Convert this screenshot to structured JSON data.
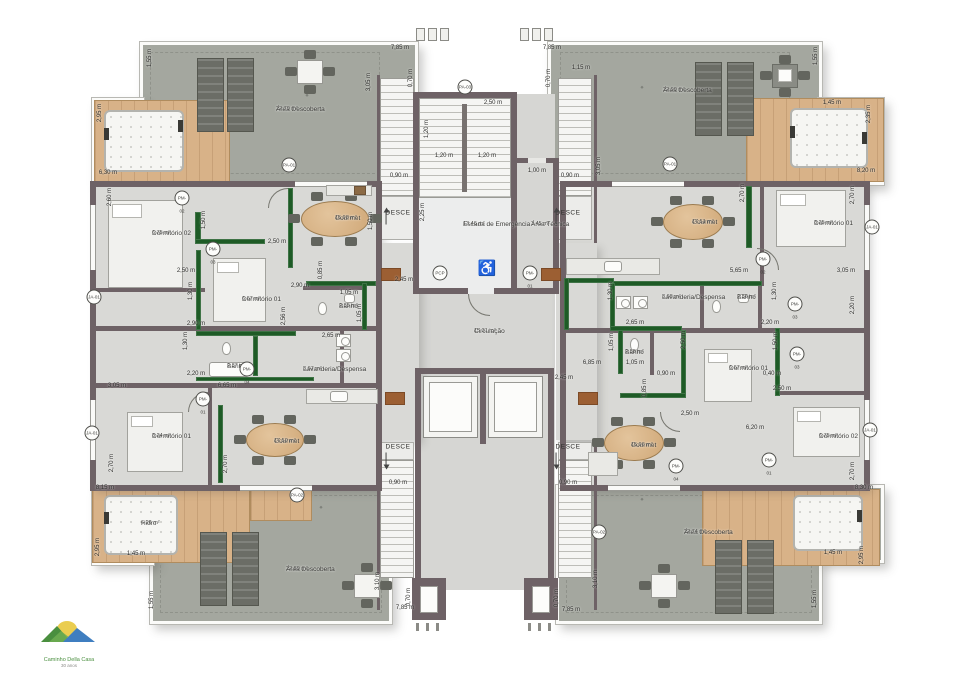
{
  "labels": {
    "desce": "DESCE"
  },
  "logo": {
    "line1": "Caminho Della Casa",
    "line2": "30 anos"
  },
  "colors": {
    "wall": "#6e6266",
    "green_wall": "#1e5b26",
    "terrace": "#a4a79f",
    "deck": "#d8b288",
    "interior": "#d9d9d6"
  },
  "rooms": [
    {
      "name": "Área Descoberta",
      "area": "22,70 m²",
      "x": 276,
      "y": 106
    },
    {
      "name": "Área Descoberta",
      "area": "22,90 m²",
      "x": 663,
      "y": 87
    },
    {
      "name": "Área Descoberta",
      "area": "22,89 m²",
      "x": 286,
      "y": 566
    },
    {
      "name": "Área Descoberta",
      "area": "22,74 m²",
      "x": 684,
      "y": 529
    },
    {
      "name": "Dormitório 02",
      "area": "6,75 m²",
      "x": 152,
      "y": 230
    },
    {
      "name": "Dormitório 01",
      "area": "6,67 m²",
      "x": 242,
      "y": 296
    },
    {
      "name": "Gourmet",
      "area": "15,98 m²",
      "x": 335,
      "y": 215
    },
    {
      "name": "Banho",
      "area": "2,85 m²",
      "x": 339,
      "y": 303
    },
    {
      "name": "Banho",
      "area": "2,87 m²",
      "x": 227,
      "y": 363
    },
    {
      "name": "Lavanderia/Despensa",
      "area": "3,67 m²",
      "x": 303,
      "y": 366
    },
    {
      "name": "Gourmet",
      "area": "17,51 m²",
      "x": 692,
      "y": 219
    },
    {
      "name": "Dormitório 01",
      "area": "8,25 m²",
      "x": 814,
      "y": 220
    },
    {
      "name": "Lavanderia/Despensa",
      "area": "3,68 m²",
      "x": 662,
      "y": 294
    },
    {
      "name": "Banho",
      "area": "2,86 m²",
      "x": 737,
      "y": 294
    },
    {
      "name": "Banho",
      "area": "2,88 m²",
      "x": 625,
      "y": 349
    },
    {
      "name": "Dormitório 01",
      "area": "6,67 m²",
      "x": 729,
      "y": 365
    },
    {
      "name": "Gourmet",
      "area": "15,96 m²",
      "x": 631,
      "y": 442
    },
    {
      "name": "Dormitório 02",
      "area": "6,75 m²",
      "x": 819,
      "y": 433
    },
    {
      "name": "Dormitório 01",
      "area": "8,24 m²",
      "x": 152,
      "y": 433
    },
    {
      "name": "Gourmet",
      "area": "17,50 m²",
      "x": 274,
      "y": 438
    },
    {
      "name": "Hidro",
      "area": "6,26 m²",
      "x": 141,
      "y": 520
    },
    {
      "name": "Escada de Emergência",
      "area": "13,46 m²",
      "x": 463,
      "y": 221
    },
    {
      "name": "Área Técnica",
      "area": "3,45 m²",
      "x": 531,
      "y": 221
    },
    {
      "name": "Circulação",
      "area": "15,31 m²",
      "x": 474,
      "y": 328
    }
  ],
  "dims": [
    {
      "t": "7,85 m",
      "x": 400,
      "y": 48
    },
    {
      "t": "0,70 m",
      "x": 411,
      "y": 78,
      "v": 1
    },
    {
      "t": "7,85 m",
      "x": 552,
      "y": 48
    },
    {
      "t": "0,70 m",
      "x": 549,
      "y": 78,
      "v": 1
    },
    {
      "t": "1,15 m",
      "x": 581,
      "y": 68
    },
    {
      "t": "2,50 m",
      "x": 493,
      "y": 103
    },
    {
      "t": "1,20 m",
      "x": 427,
      "y": 129,
      "v": 1
    },
    {
      "t": "1,20 m",
      "x": 444,
      "y": 156
    },
    {
      "t": "1,20 m",
      "x": 487,
      "y": 156
    },
    {
      "t": "1,00 m",
      "x": 537,
      "y": 171
    },
    {
      "t": "0,90 m",
      "x": 399,
      "y": 176
    },
    {
      "t": "0,90 m",
      "x": 570,
      "y": 176
    },
    {
      "t": "2,25 m",
      "x": 423,
      "y": 212,
      "v": 1
    },
    {
      "t": "3,05 m",
      "x": 369,
      "y": 82,
      "v": 1
    },
    {
      "t": "3,05 m",
      "x": 599,
      "y": 166,
      "v": 1
    },
    {
      "t": "1,55 m",
      "x": 150,
      "y": 58,
      "v": 1
    },
    {
      "t": "2,95 m",
      "x": 100,
      "y": 113,
      "v": 1
    },
    {
      "t": "6,30 m",
      "x": 108,
      "y": 173
    },
    {
      "t": "2,60 m",
      "x": 110,
      "y": 197,
      "v": 1
    },
    {
      "t": "1,50 m",
      "x": 204,
      "y": 220,
      "v": 1
    },
    {
      "t": "2,50 m",
      "x": 277,
      "y": 242
    },
    {
      "t": "1,50 m",
      "x": 371,
      "y": 221,
      "v": 1
    },
    {
      "t": "2,50 m",
      "x": 186,
      "y": 271
    },
    {
      "t": "2,45 m",
      "x": 404,
      "y": 280
    },
    {
      "t": "1,30 m",
      "x": 191,
      "y": 291,
      "v": 1
    },
    {
      "t": "2,90 m",
      "x": 300,
      "y": 286
    },
    {
      "t": "0,85 m",
      "x": 321,
      "y": 270,
      "v": 1
    },
    {
      "t": "1,05 m",
      "x": 349,
      "y": 293
    },
    {
      "t": "1,05 m",
      "x": 360,
      "y": 313,
      "v": 1
    },
    {
      "t": "2,90 m",
      "x": 196,
      "y": 324
    },
    {
      "t": "2,56 m",
      "x": 284,
      "y": 316,
      "v": 1
    },
    {
      "t": "1,30 m",
      "x": 186,
      "y": 341,
      "v": 1
    },
    {
      "t": "2,20 m",
      "x": 196,
      "y": 374
    },
    {
      "t": "2,65 m",
      "x": 331,
      "y": 336
    },
    {
      "t": "6,65 m",
      "x": 227,
      "y": 386
    },
    {
      "t": "3,05 m",
      "x": 117,
      "y": 386
    },
    {
      "t": "1,55 m",
      "x": 816,
      "y": 56,
      "v": 1
    },
    {
      "t": "1,45 m",
      "x": 832,
      "y": 103
    },
    {
      "t": "2,35 m",
      "x": 869,
      "y": 114,
      "v": 1
    },
    {
      "t": "8,20 m",
      "x": 866,
      "y": 171
    },
    {
      "t": "2,70 m",
      "x": 743,
      "y": 193,
      "v": 1
    },
    {
      "t": "2,70 m",
      "x": 853,
      "y": 195,
      "v": 1
    },
    {
      "t": "5,65 m",
      "x": 739,
      "y": 271
    },
    {
      "t": "3,05 m",
      "x": 846,
      "y": 271
    },
    {
      "t": "1,30 m",
      "x": 611,
      "y": 291,
      "v": 1
    },
    {
      "t": "1,30 m",
      "x": 775,
      "y": 291,
      "v": 1
    },
    {
      "t": "2,65 m",
      "x": 635,
      "y": 323
    },
    {
      "t": "2,20 m",
      "x": 770,
      "y": 323
    },
    {
      "t": "2,20 m",
      "x": 853,
      "y": 305,
      "v": 1
    },
    {
      "t": "1,05 m",
      "x": 612,
      "y": 342,
      "v": 1
    },
    {
      "t": "1,05 m",
      "x": 635,
      "y": 363
    },
    {
      "t": "6,85 m",
      "x": 592,
      "y": 363
    },
    {
      "t": "2,45 m",
      "x": 564,
      "y": 378
    },
    {
      "t": "0,90 m",
      "x": 666,
      "y": 374
    },
    {
      "t": "0,85 m",
      "x": 645,
      "y": 388,
      "v": 1
    },
    {
      "t": "2,50 m",
      "x": 684,
      "y": 340,
      "v": 1
    },
    {
      "t": "1,50 m",
      "x": 776,
      "y": 341,
      "v": 1
    },
    {
      "t": "0,40 m",
      "x": 772,
      "y": 374
    },
    {
      "t": "2,50 m",
      "x": 782,
      "y": 389
    },
    {
      "t": "2,50 m",
      "x": 690,
      "y": 414
    },
    {
      "t": "6,20 m",
      "x": 755,
      "y": 428
    },
    {
      "t": "2,70 m",
      "x": 853,
      "y": 471,
      "v": 1
    },
    {
      "t": "8,30 m",
      "x": 864,
      "y": 488
    },
    {
      "t": "1,45 m",
      "x": 833,
      "y": 553
    },
    {
      "t": "2,95 m",
      "x": 862,
      "y": 555,
      "v": 1
    },
    {
      "t": "1,55 m",
      "x": 815,
      "y": 599,
      "v": 1
    },
    {
      "t": "3,10 m",
      "x": 596,
      "y": 579,
      "v": 1
    },
    {
      "t": "0,70 m",
      "x": 557,
      "y": 598,
      "v": 1
    },
    {
      "t": "7,85 m",
      "x": 571,
      "y": 610
    },
    {
      "t": "2,70 m",
      "x": 112,
      "y": 463,
      "v": 1
    },
    {
      "t": "2,70 m",
      "x": 226,
      "y": 464,
      "v": 1
    },
    {
      "t": "8,15 m",
      "x": 105,
      "y": 488
    },
    {
      "t": "2,95 m",
      "x": 98,
      "y": 547,
      "v": 1
    },
    {
      "t": "1,45 m",
      "x": 136,
      "y": 554
    },
    {
      "t": "1,55 m",
      "x": 152,
      "y": 600,
      "v": 1
    },
    {
      "t": "3,10 m",
      "x": 378,
      "y": 581,
      "v": 1
    },
    {
      "t": "0,70 m",
      "x": 409,
      "y": 597,
      "v": 1
    },
    {
      "t": "7,85 m",
      "x": 405,
      "y": 608
    },
    {
      "t": "0,90 m",
      "x": 398,
      "y": 483
    },
    {
      "t": "0,90 m",
      "x": 568,
      "y": 483
    }
  ],
  "desce_arrows": [
    {
      "x": 398,
      "y": 213,
      "dir": "up"
    },
    {
      "x": 568,
      "y": 213,
      "dir": "up"
    },
    {
      "x": 398,
      "y": 447,
      "dir": "down"
    },
    {
      "x": 568,
      "y": 447,
      "dir": "down"
    }
  ],
  "tags": [
    {
      "code": "PM-02",
      "x": 182,
      "y": 198
    },
    {
      "code": "PM-03",
      "x": 213,
      "y": 249
    },
    {
      "code": "PA-01",
      "x": 289,
      "y": 165
    },
    {
      "code": "PA-01",
      "x": 670,
      "y": 164
    },
    {
      "code": "PM-04",
      "x": 247,
      "y": 369
    },
    {
      "code": "PA-02",
      "x": 297,
      "y": 495
    },
    {
      "code": "PA-02",
      "x": 599,
      "y": 532
    },
    {
      "code": "PCP",
      "x": 440,
      "y": 273
    },
    {
      "code": "PM-01",
      "x": 530,
      "y": 273
    },
    {
      "code": "PM-02",
      "x": 763,
      "y": 259
    },
    {
      "code": "PM-03",
      "x": 795,
      "y": 304
    },
    {
      "code": "PM-03",
      "x": 797,
      "y": 354
    },
    {
      "code": "PM-01",
      "x": 769,
      "y": 460
    },
    {
      "code": "PM-01",
      "x": 203,
      "y": 399
    },
    {
      "code": "PM-04",
      "x": 676,
      "y": 466
    },
    {
      "code": "JA-01",
      "x": 94,
      "y": 297
    },
    {
      "code": "JA-01",
      "x": 92,
      "y": 433
    },
    {
      "code": "JA-01",
      "x": 872,
      "y": 227
    },
    {
      "code": "JA-01",
      "x": 870,
      "y": 430
    },
    {
      "code": "PA-03",
      "x": 465,
      "y": 87
    }
  ]
}
